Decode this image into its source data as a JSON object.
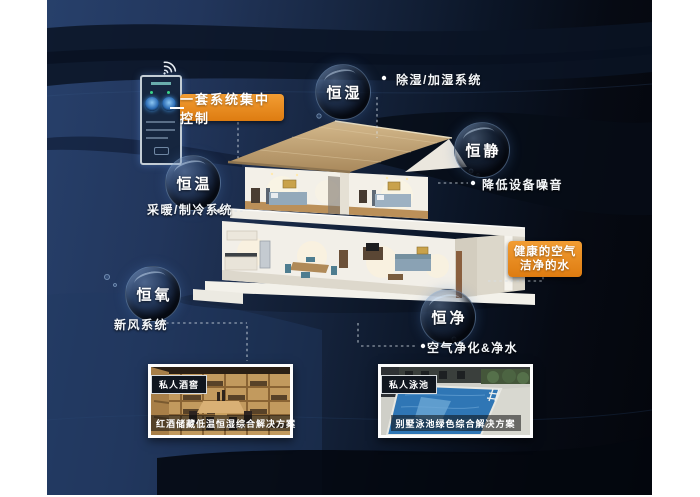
{
  "control_panel": {
    "label": "一套系统集中控制",
    "device": "wall-mounted smart control panel",
    "wifi": "wifi-signal"
  },
  "features": [
    {
      "name": "恒湿",
      "desc": "除湿/加湿系统"
    },
    {
      "name": "恒静",
      "desc": "降低设备噪音"
    },
    {
      "name": "恒温",
      "desc": "采暖/制冷系统"
    },
    {
      "name": "恒氧",
      "desc": "新风系统"
    },
    {
      "name": "恒净",
      "desc": "空气净化&净水"
    }
  ],
  "highlight": {
    "line1": "健康的空气",
    "line2": "洁净的水"
  },
  "cards": [
    {
      "tag": "私人酒窖",
      "caption": "红酒储藏低温恒湿综合解决方案"
    },
    {
      "tag": "私人泳池",
      "caption": "别墅泳池绿色综合解决方案"
    }
  ],
  "colors": {
    "accent_orange": "#e8831c",
    "background_navy": "#22365c",
    "background_dark": "#05080f",
    "bubble_rim": "#8fb4dc",
    "roof_tan": "#c2a377"
  }
}
